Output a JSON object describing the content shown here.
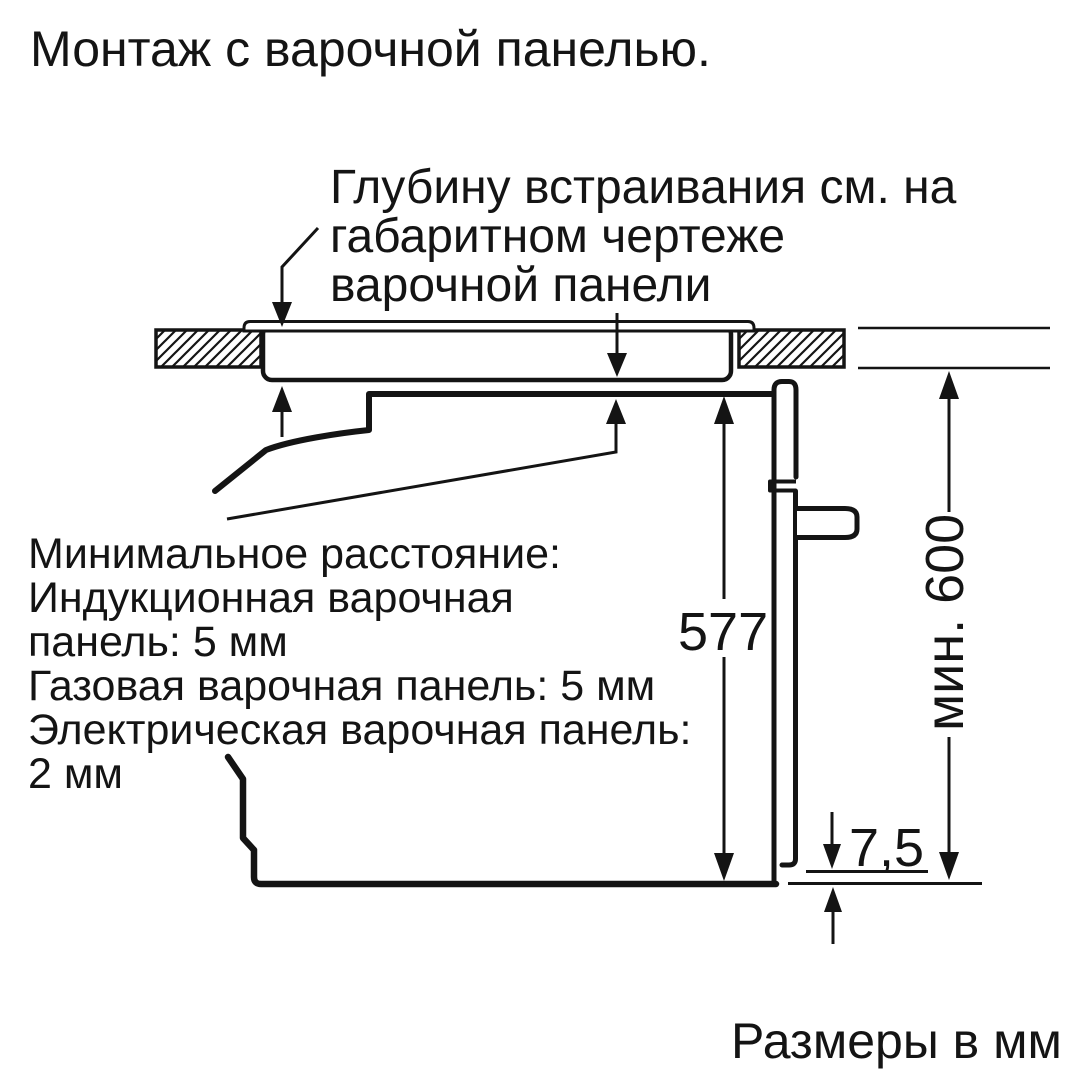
{
  "title": "Монтаж с варочной панелью.",
  "footer": "Размеры в мм",
  "annotations": {
    "depth_note": {
      "lines": [
        "Глубину встраивания см. на",
        "габаритном чертеже",
        "варочной панели"
      ]
    },
    "min_distance_note": {
      "lines": [
        "Минимальное расстояние:",
        "Индукционная варочная",
        "панель: 5 мм",
        "Газовая варочная панель: 5 мм",
        "Электрическая варочная панель:",
        "2 мм"
      ]
    }
  },
  "dimensions": {
    "oven_height": "577",
    "bottom_gap": "7,5",
    "min_niche_height": "мин. 600"
  },
  "colors": {
    "ink": "#141414",
    "background": "#ffffff"
  }
}
